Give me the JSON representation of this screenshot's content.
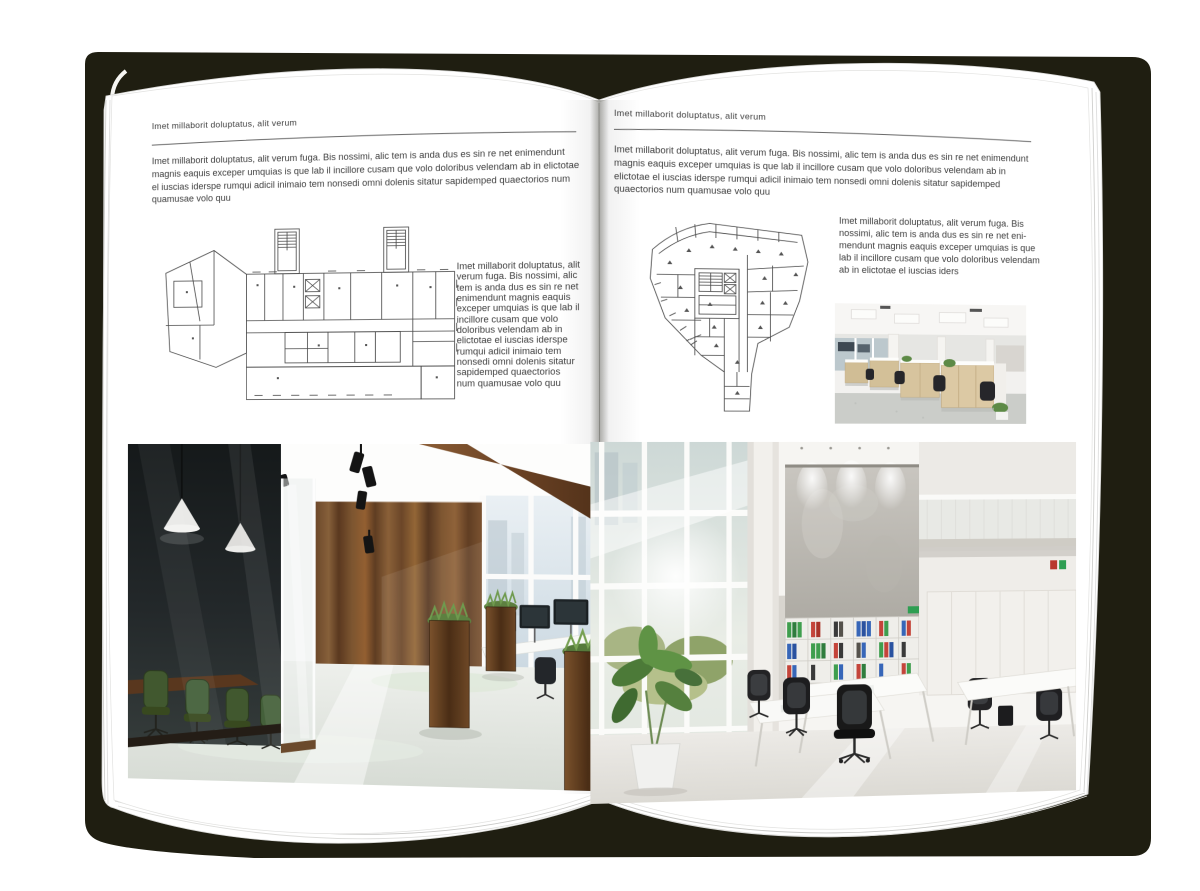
{
  "mockup": {
    "kind": "open-magazine-spread",
    "palette": {
      "backdrop": "#1f1e11",
      "page": "#ffffff",
      "body_text": "#3e3e3e",
      "rule": "#6b6b6b",
      "wood": "#6b4628",
      "meeting_chair_green": "#41582f",
      "binder_green": "#3f9e4e",
      "binder_red": "#c4443a",
      "binder_blue": "#3766b8"
    }
  },
  "left_page": {
    "kicker": "Imet millaborit doluptatus, alit verum",
    "intro": "Imet millaborit doluptatus, alit verum fuga. Bis nossimi, alic tem is anda dus es sin re net enimendunt magnis eaquis exceper umquias is que lab il incillore cusam que volo doloribus velendam ab in elictotae el iuscias iderspe rumqui adicil inimaio tem nonsedi omni dolenis sitatur sapidemped quaectorios num quamusae volo quu",
    "side_text": "Imet millaborit doluptatus, alit verum fuga. Bis nossimi, alic tem is anda dus es sin re net enimendunt magnis eaquis exceper umquias is que lab il incillore cusam que volo doloribus velendam ab in elictotae el iuscias iderspe rumqui adicil inimaio tem nonsedi omni dolenis sitatur sapidemped quaectorios num quamusae volo quu"
  },
  "right_page": {
    "kicker": "Imet millaborit doluptatus, alit verum",
    "intro": "Imet millaborit doluptatus, alit verum fuga. Bis nossimi, alic tem is anda dus es sin re net enimendunt magnis eaquis exceper umquias is que lab il incillore cusam que volo doloribus velendam ab in elictotae el iuscias iderspe rumqui adicil inimaio tem nonsedi omni dolenis sitatur sapidemped quaectorios num quamusae volo quu",
    "side_text": "Imet millaborit doluptatus, alit verum fuga. Bis nossimi, alic tem is anda dus es sin re net eni-mendunt magnis eaquis exceper umquias is que lab il incillore cusam que volo doloribus velendam ab in elictotae el iuscias iders"
  }
}
